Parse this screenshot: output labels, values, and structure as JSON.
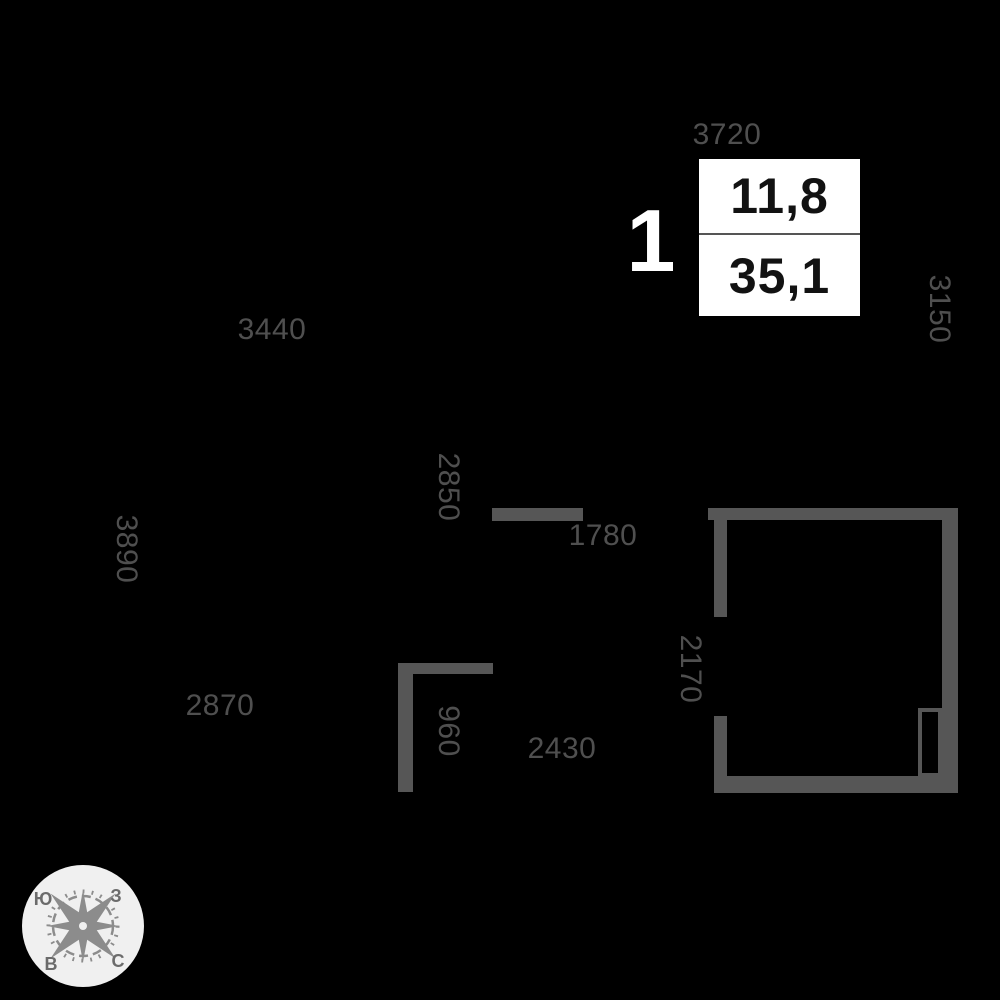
{
  "colors": {
    "background": "#000000",
    "wall": "#565656",
    "dimension_text": "#4f4f4f",
    "box_bg": "#ffffff",
    "box_text": "#121212",
    "divider": "#555555",
    "unit_text": "#ffffff",
    "compass_circle": "#f0f0f0",
    "compass_rose": "#8c8c8c",
    "compass_letters": "#6b6b6b"
  },
  "unit_info": {
    "rooms": "1",
    "living_area": "11,8",
    "total_area": "35,1"
  },
  "floorplan": {
    "dimensions": [
      {
        "value": "3720",
        "orientation": "h",
        "x": 727,
        "y": 135
      },
      {
        "value": "3150",
        "orientation": "v",
        "x": 939,
        "y": 309
      },
      {
        "value": "3440",
        "orientation": "h",
        "x": 272,
        "y": 330
      },
      {
        "value": "2850",
        "orientation": "v",
        "x": 448,
        "y": 487
      },
      {
        "value": "1780",
        "orientation": "h",
        "x": 603,
        "y": 536
      },
      {
        "value": "3890",
        "orientation": "v",
        "x": 126,
        "y": 549
      },
      {
        "value": "2170",
        "orientation": "v",
        "x": 690,
        "y": 669
      },
      {
        "value": "2870",
        "orientation": "h",
        "x": 220,
        "y": 706
      },
      {
        "value": "960",
        "orientation": "v",
        "x": 448,
        "y": 731
      },
      {
        "value": "2430",
        "orientation": "h",
        "x": 562,
        "y": 749
      }
    ],
    "walls": [
      {
        "x": 492,
        "y": 508,
        "w": 91,
        "h": 13
      },
      {
        "x": 708,
        "y": 508,
        "w": 250,
        "h": 12
      },
      {
        "x": 714,
        "y": 508,
        "w": 13,
        "h": 109
      },
      {
        "x": 714,
        "y": 716,
        "w": 13,
        "h": 62
      },
      {
        "x": 942,
        "y": 508,
        "w": 16,
        "h": 285
      },
      {
        "x": 714,
        "y": 776,
        "w": 244,
        "h": 17
      },
      {
        "x": 398,
        "y": 663,
        "w": 95,
        "h": 11
      },
      {
        "x": 398,
        "y": 663,
        "w": 15,
        "h": 129
      }
    ],
    "shaft": {
      "x": 918,
      "y": 708,
      "w": 24,
      "h": 69
    }
  },
  "compass": {
    "south": "Ю",
    "west": "З",
    "east": "В",
    "north": "С"
  }
}
